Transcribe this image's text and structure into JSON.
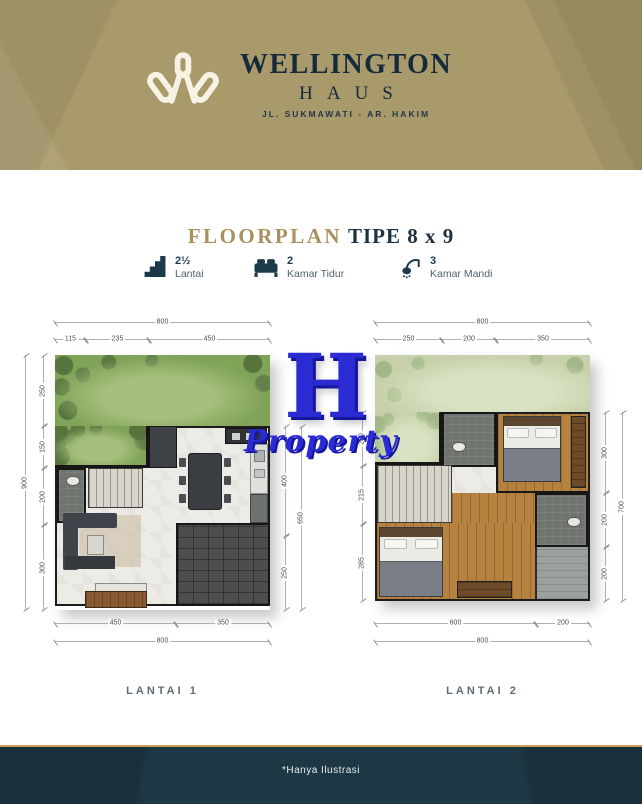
{
  "brand": {
    "name": "WELLINGTON",
    "sub": "HAUS",
    "address": "JL. SUKMAWATI - AR. HAKIM"
  },
  "section": {
    "title_accent": "FLOORPLAN",
    "title_rest": "TIPE 8 x 9"
  },
  "features": [
    {
      "icon": "stairs-icon",
      "value": "2½",
      "label": "Lantai"
    },
    {
      "icon": "bed-icon",
      "value": "2",
      "label": "Kamar Tidur"
    },
    {
      "icon": "shower-icon",
      "value": "3",
      "label": "Kamar Mandi"
    }
  ],
  "watermark": {
    "letter": "H",
    "text": "Property",
    "color": "#2b2bd4"
  },
  "plans": [
    {
      "label": "LANTAI 1",
      "dims": {
        "top_total": "800",
        "top_segments": [
          "115",
          "235",
          "450"
        ],
        "left_total": "900",
        "left_segments": [
          "250",
          "150",
          "200",
          "300"
        ],
        "right_total": "650",
        "right_segments": [
          "400",
          "250"
        ],
        "bottom_total": "800",
        "bottom_segments": [
          "450",
          "350"
        ]
      }
    },
    {
      "label": "LANTAI 2",
      "dims": {
        "top_total": "800",
        "top_segments": [
          "250",
          "200",
          "350"
        ],
        "left_segments": [
          "200",
          "215",
          "285"
        ],
        "right_total": "700",
        "right_segments": [
          "300",
          "200",
          "200"
        ],
        "bottom_total": "800",
        "bottom_segments": [
          "600",
          "200"
        ]
      }
    }
  ],
  "footer": {
    "note": "*Hanya Ilustrasi"
  },
  "colors": {
    "header_gold": "#a89a6b",
    "navy": "#1d3844",
    "title_gold": "#a8915c",
    "watermark_blue": "#2b2bd4",
    "footer_line_gold": "#c9a14e"
  }
}
